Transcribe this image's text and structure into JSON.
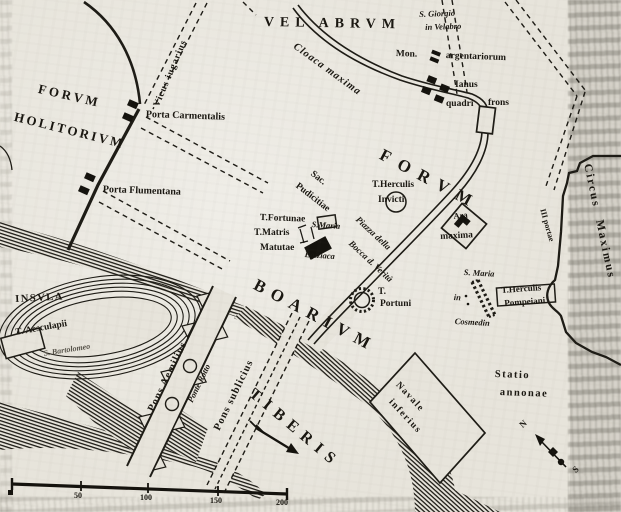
{
  "map": {
    "labels": {
      "forum_holitorium_line1": "FORVM",
      "forum_holitorium_line2": "HOLITORIVM",
      "velabrum": "VEL ABRVM",
      "s_giorgio_line1": "S. Giorgio",
      "s_giorgio_line2": "in Velabro",
      "mon_argentariorum_line1": "Mon.",
      "mon_argentariorum_line2": "argentariorum",
      "cloaca_maxima": "Cloaca maxima",
      "ianus": "Ianus",
      "quadri": "quadri",
      "frons": "frons",
      "vicus_iugarius": "Vicus iugarius",
      "porta_carmentalis": "Porta Carmentalis",
      "porta_flumentana": "Porta Flumentana",
      "forum_boarium_line1": "FORVM",
      "forum_boarium_line2": "BOARIVM",
      "sacellum_line1": "Sac.",
      "sacellum_line2": "Pudicitiae",
      "t_fortunae": "T.Fortunae",
      "t_matris_line1": "T.Matris",
      "t_matris_line2": "Matutae",
      "s_maria_egiziaca_line1": "S.Maria",
      "s_maria_egiziaca_line2": "Egiziaca",
      "t_herculis_invicti_line1": "T.Herculis",
      "t_herculis_invicti_line2": "Invicti",
      "ara_maxima_line1": "Ara",
      "ara_maxima_line2": "maxima",
      "piazza_line1": "Piazza della",
      "piazza_line2": "Bocca d. Verità",
      "t_portuni_line1": "T.",
      "t_portuni_line2": "Portuni",
      "s_maria_cosmedin_line1": "S. Maria",
      "s_maria_cosmedin_line2": "in",
      "s_maria_cosmedin_line3": "Cosmedin",
      "t_herculis_pompeiani_line1": "T.Herculis",
      "t_herculis_pompeiani_line2": "Pompeiani",
      "circus_maximus": "Circus Maximus",
      "iii_portae": "III portae",
      "statio_line1": "Statio",
      "statio_line2": "annonae",
      "navale_line1": "Navale",
      "navale_line2": "inferius",
      "tiberis": "TIBERIS",
      "insula": "INSVLA",
      "t_aesculapii": "T. Aesculapii",
      "s_bartolomeo": "S. Bartolomeo",
      "pons_aemilius": "Pons Aemilius",
      "ponte_rotto": "Ponte Rotto",
      "pons_sublicius": "Pons sublicius"
    },
    "scale_bar": {
      "ticks": [
        "50",
        "100",
        "150",
        "200"
      ]
    },
    "compass": {
      "n": "N",
      "s": "S"
    }
  }
}
